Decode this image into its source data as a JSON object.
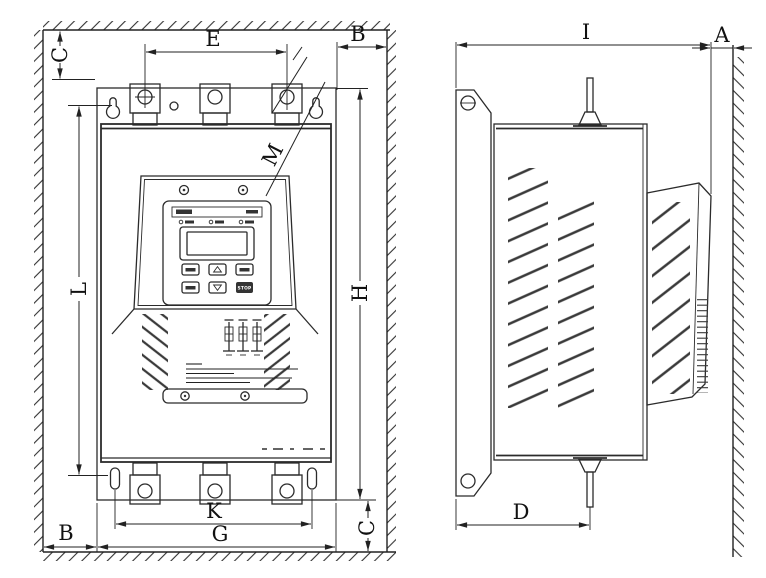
{
  "drawing": {
    "ink_color": "#222222",
    "background_color": "#ffffff",
    "views": {
      "front": {
        "label_c_top": "C",
        "label_e": "E",
        "label_b_top": "B",
        "label_l": "L",
        "label_h": "H",
        "label_m": "M",
        "label_b_bottom": "B",
        "label_k": "K",
        "label_g": "G",
        "label_c_bottom": "C"
      },
      "side": {
        "label_i": "I",
        "label_a": "A",
        "label_d": "D"
      }
    },
    "panel": {
      "stop_label": "STOP"
    }
  }
}
